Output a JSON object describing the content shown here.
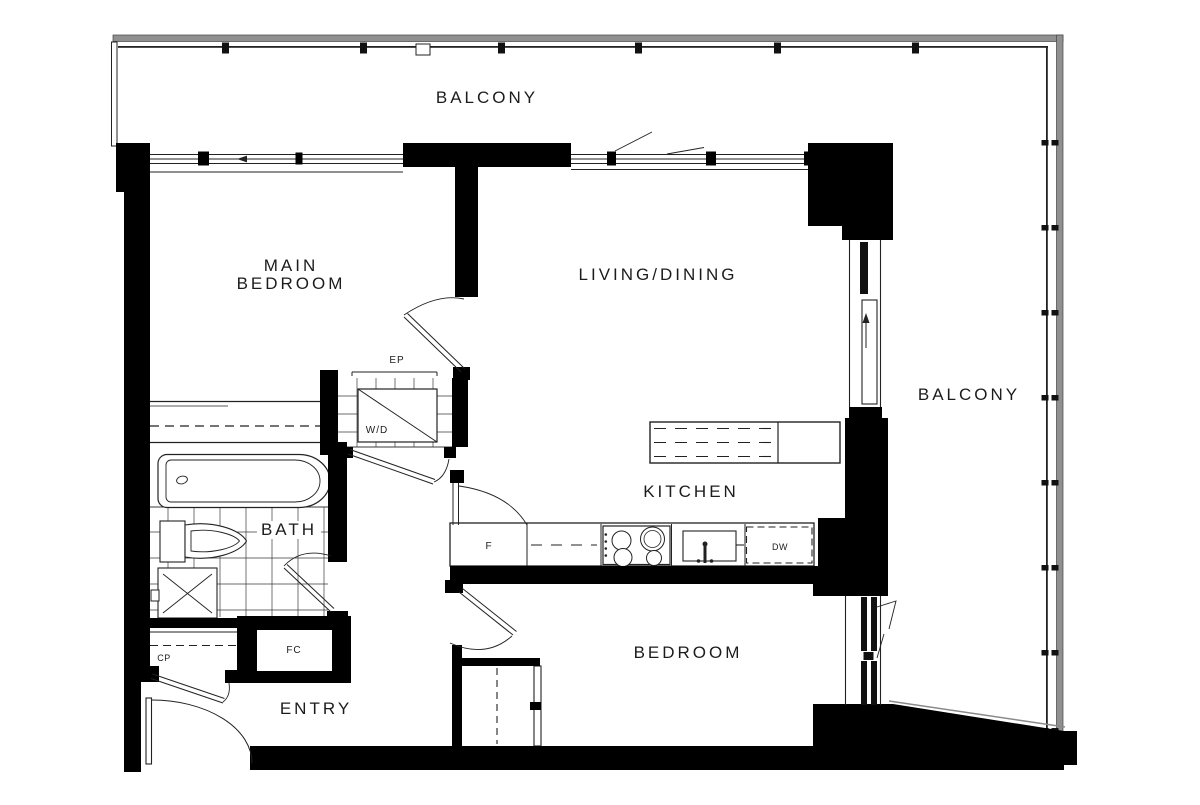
{
  "colors": {
    "wall": "#000000",
    "line": "#222222",
    "railing": "#909090",
    "background": "#ffffff"
  },
  "rooms": {
    "balcony_top": "BALCONY",
    "main_bedroom_line1": "MAIN",
    "main_bedroom_line2": "BEDROOM",
    "living_dining": "LIVING/DINING",
    "balcony_right": "BALCONY",
    "kitchen": "KITCHEN",
    "bath": "BATH",
    "entry": "ENTRY",
    "bedroom": "BEDROOM"
  },
  "labels": {
    "electrical_panel": "EP",
    "washer_dryer": "W/D",
    "coat_closet": "CP",
    "fan_coil": "FC",
    "fridge": "F",
    "dishwasher": "DW"
  }
}
